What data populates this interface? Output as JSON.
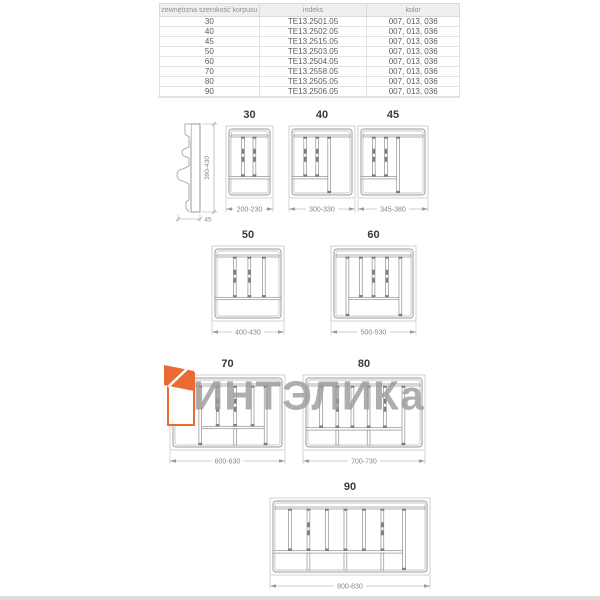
{
  "table": {
    "headers": [
      "zewnętrzna szerokość korpusu",
      "indeks",
      "kolor"
    ],
    "rows": [
      [
        "30",
        "TE13.2501.05",
        "007, 013, 036"
      ],
      [
        "40",
        "TE13.2502.05",
        "007, 013, 036"
      ],
      [
        "45",
        "TE13.2515.05",
        "007, 013, 036"
      ],
      [
        "50",
        "TE13.2503.05",
        "007, 013, 036"
      ],
      [
        "60",
        "TE13.2504.05",
        "007, 013, 036"
      ],
      [
        "70",
        "TE13.2558.05",
        "007, 013, 036"
      ],
      [
        "80",
        "TE13.2505.05",
        "007, 013, 036"
      ],
      [
        "90",
        "TE13.2506.05",
        "007, 013, 036"
      ]
    ]
  },
  "side_view": {
    "height_dim": "390-430",
    "depth_dim": "45"
  },
  "trays": [
    {
      "label": "30",
      "dim": "200-230",
      "w": 47,
      "h": 72,
      "dividers": [
        0.34,
        0.62
      ],
      "handles": [
        0,
        1
      ],
      "hdiv": [
        0,
        1
      ],
      "hdiv_y": 0.72,
      "stubs": [],
      "full": []
    },
    {
      "label": "40",
      "dim": "300-330",
      "w": 66,
      "h": 72,
      "dividers": [
        0.22,
        0.42,
        0.62
      ],
      "handles": [
        0,
        1
      ],
      "hdiv": [
        0,
        0.62
      ],
      "hdiv_y": 0.72,
      "stubs": [],
      "full": [
        2
      ]
    },
    {
      "label": "45",
      "dim": "345-380",
      "w": 70,
      "h": 72,
      "dividers": [
        0.2,
        0.39,
        0.58
      ],
      "handles": [
        0,
        1
      ],
      "hdiv": [
        0,
        0.58
      ],
      "hdiv_y": 0.72,
      "stubs": [],
      "full": [
        2
      ]
    },
    {
      "label": "50",
      "dim": "400-430",
      "w": 72,
      "h": 75,
      "dividers": [
        0.3,
        0.52,
        0.74
      ],
      "handles": [
        0,
        1
      ],
      "hdiv": [
        0,
        1
      ],
      "hdiv_y": 0.7,
      "stubs": [],
      "full": []
    },
    {
      "label": "60",
      "dim": "500-530",
      "w": 85,
      "h": 75,
      "dividers": [
        0.17,
        0.34,
        0.5,
        0.67,
        0.84
      ],
      "handles": [
        2,
        3
      ],
      "hdiv": [
        0.17,
        0.84
      ],
      "hdiv_y": 0.7,
      "stubs": [],
      "full": [
        0,
        4
      ]
    },
    {
      "label": "70",
      "dim": "600-630",
      "w": 115,
      "h": 75,
      "dividers": [
        0.25,
        0.41,
        0.57,
        0.73,
        0.85
      ],
      "handles": [
        1,
        2
      ],
      "hdiv": [
        0.25,
        0.85
      ],
      "hdiv_y": 0.7,
      "stubs": [
        0.57
      ],
      "full": [
        0,
        4
      ]
    },
    {
      "label": "80",
      "dim": "700-730",
      "w": 122,
      "h": 75,
      "dividers": [
        0.13,
        0.27,
        0.4,
        0.54,
        0.68,
        0.84
      ],
      "handles": [
        1,
        4
      ],
      "hdiv": [
        0,
        0.84
      ],
      "hdiv_y": 0.72,
      "stubs": [
        0.27,
        0.54
      ],
      "full": [
        5
      ]
    },
    {
      "label": "90",
      "dim": "800-830",
      "w": 160,
      "h": 77,
      "dividers": [
        0.11,
        0.23,
        0.35,
        0.47,
        0.59,
        0.71,
        0.85
      ],
      "handles": [
        1,
        5
      ],
      "hdiv": [
        0,
        0.85
      ],
      "hdiv_y": 0.7,
      "stubs": [
        0.23,
        0.47,
        0.71
      ],
      "full": [
        6
      ]
    }
  ],
  "watermark": {
    "text": "ИНТЭЛИКа"
  },
  "colors": {
    "accent_orange": "#e96a32",
    "watermark_gray": "#9b9b9b",
    "drawing_line": "#9a9a9a",
    "divider_dark": "#7d7d7d",
    "outer_line": "#c6c6c6",
    "dim_text": "#868686"
  }
}
